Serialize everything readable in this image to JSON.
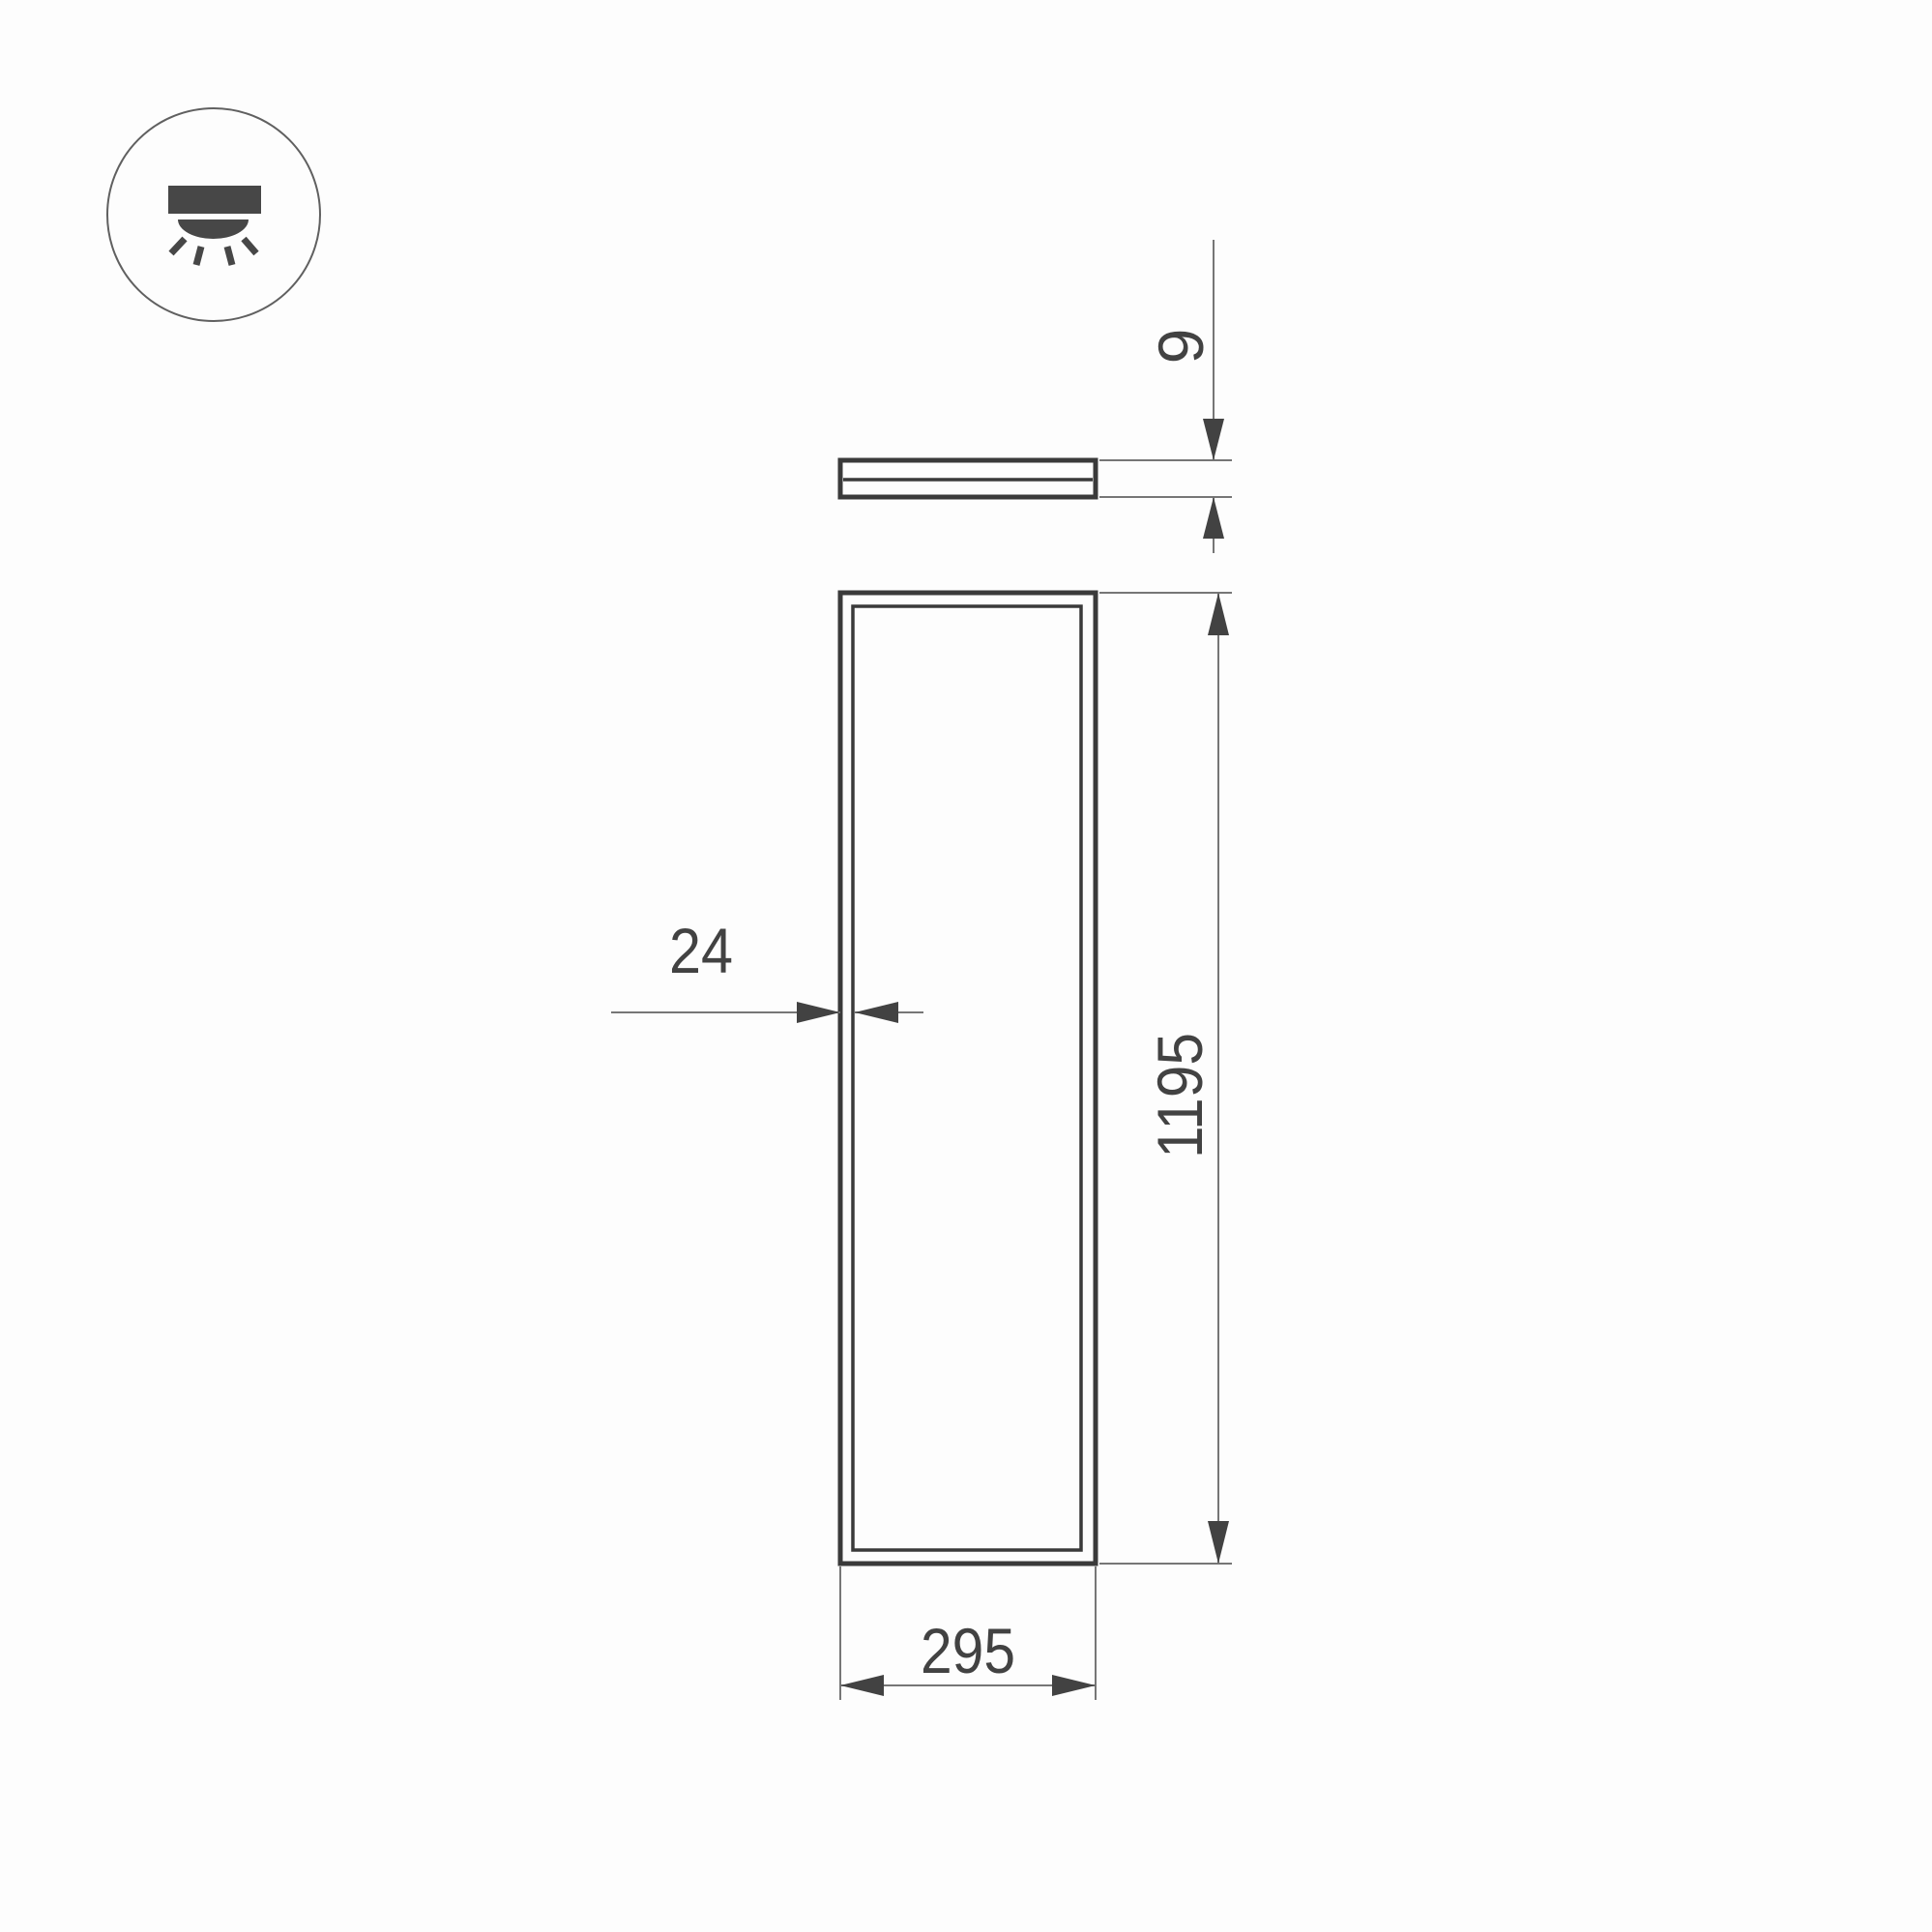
{
  "colors": {
    "background": "#fdfdfd",
    "outline": "#3a3a3a",
    "dimension": "#424242",
    "extension_line": "#767676",
    "icon": "#474747",
    "icon_circle": "#606060"
  },
  "icon": {
    "name": "downlight-icon"
  },
  "dimensions": {
    "thickness": "9",
    "frame": "24",
    "length": "1195",
    "width": "295"
  }
}
